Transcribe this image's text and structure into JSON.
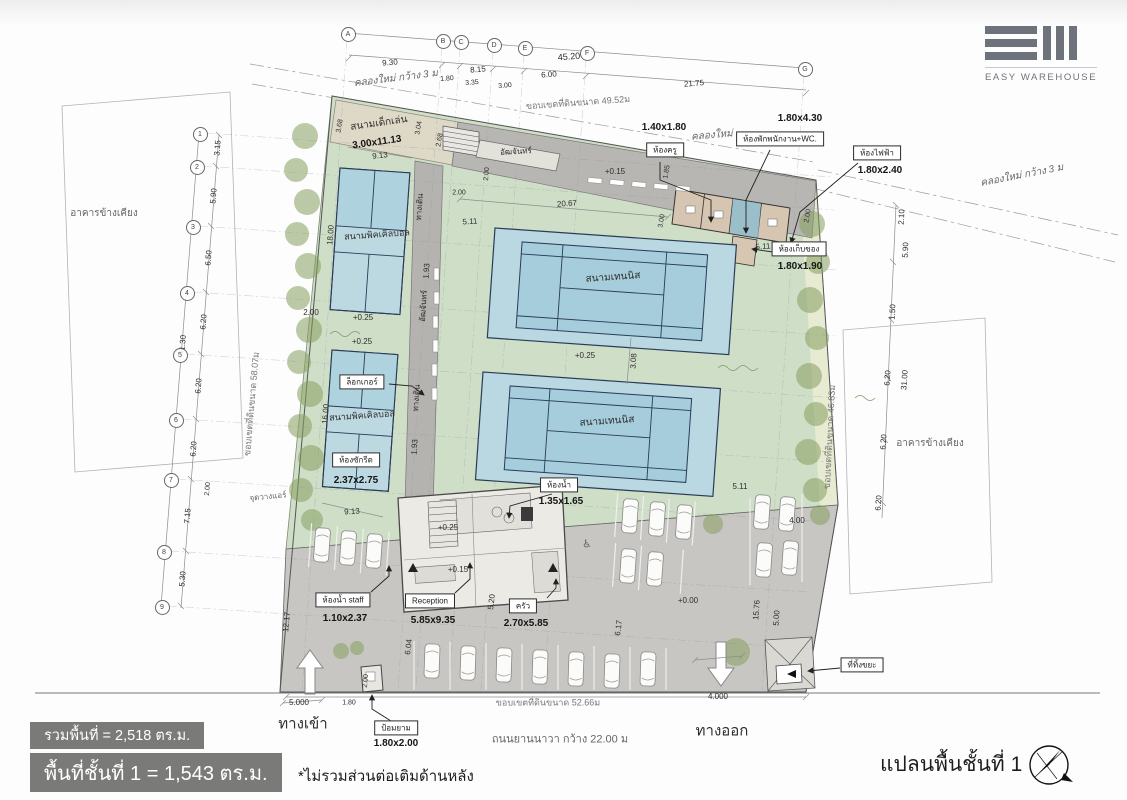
{
  "brand": {
    "name": "EASY WAREHOUSE"
  },
  "plan": {
    "title": "แปลนพื้นชั้นที่ 1",
    "summary": {
      "total_area": "รวมพื้นที่ = 2,518 ตร.ม.",
      "floor1_area": "พื้นที่ชั้นที่ 1 = 1,543 ตร.ม.",
      "note": "*ไม่รวมส่วนต่อเติมด้านหลัง"
    }
  },
  "site": {
    "boundary_top": "ขอบเขตที่ดินขนาด 49.52ม",
    "boundary_left": "ขอบเขตที่ดินขนาด 58.07ม",
    "boundary_right": "ขอบเขตที่ดินขนาด 46.83ม",
    "boundary_bottom": "ขอบเขตที่ดินขนาด 52.66ม",
    "road": "ถนนยานนาวา กว้าง 22.00 ม",
    "canal_left": "คลองใหม่ กว้าง 3 ม",
    "canal_right": "คลองใหม่ กว้าง 3 ม",
    "canal_top": "คลองใหม่",
    "neighbor_left": "อาคารข้างเคียง",
    "neighbor_right": "อาคารข้างเคียง",
    "entrance": "ทางเข้า",
    "exit": "ทางออก",
    "walkway": "ทางเดิน",
    "grandstand": "อัฒจันทร์"
  },
  "areas": {
    "playground": {
      "label": "สนามเด็กเล่น",
      "size": "3.00x11.13"
    },
    "pickleball_1": {
      "label": "สนามพิคเคิลบอล"
    },
    "pickleball_2": {
      "label": "สนามพิคเคิลบอล"
    },
    "tennis_1": {
      "label": "สนามเทนนิส"
    },
    "tennis_2": {
      "label": "สนามเทนนิส"
    }
  },
  "callouts": {
    "teacher_room": {
      "label": "ห้องครู",
      "size": "1.40x1.80"
    },
    "staff_room_wc": {
      "label": "ห้องพักพนักงาน+WC.",
      "size": "1.80x4.30"
    },
    "electrical_room": {
      "label": "ห้องไฟฟ้า",
      "size": "1.80x2.40"
    },
    "storage_room": {
      "label": "ห้องเก็บของ",
      "size": "1.80x1.90"
    },
    "locker": {
      "label": "ล็อกเกอร์"
    },
    "laundry_room": {
      "label": "ห้องซักรีด",
      "size": "2.37x2.75"
    },
    "toilet": {
      "label": "ห้องน้ำ",
      "size": "1.35x1.65"
    },
    "staff_toilet": {
      "label": "ห้องน้ำ staff",
      "size": "1.10x2.37"
    },
    "reception": {
      "label": "Reception",
      "size": "5.85x9.35"
    },
    "kitchen": {
      "label": "ครัว",
      "size": "2.70x5.85"
    },
    "guard_post": {
      "label": "ป้อมยาม",
      "size": "1.80x2.00"
    },
    "trash_area": {
      "label": "ที่ทิ้งขยะ"
    }
  },
  "misc": {
    "ac_point": "จุดวางแอร์",
    "wheelchair": "♿"
  },
  "levels": {
    "p25": "+0.25",
    "p15": "+0.15",
    "p00": "+0.00"
  },
  "grid": {
    "columns": [
      "A",
      "B",
      "C",
      "D",
      "E",
      "F",
      "G"
    ],
    "rows": [
      "1",
      "2",
      "3",
      "4",
      "5",
      "6",
      "7",
      "8",
      "9"
    ]
  },
  "dimensions": {
    "top_overall": "45.20",
    "top": [
      "9.30",
      "8.15",
      "6.00",
      "21.75"
    ],
    "top_sub": [
      "1.80",
      "3.35",
      "3.00"
    ],
    "left": [
      "3.15",
      "5.90",
      "6.50",
      "6.20",
      "6.20",
      "6.20",
      "7.15",
      "5.30"
    ],
    "left_overall": "41.30",
    "right": [
      "2.10",
      "5.90",
      "1.50",
      "6.20",
      "6.20",
      "6.20",
      "4.00"
    ],
    "right_overall": "31.00",
    "court": [
      "20.67",
      "5.11",
      "3.08",
      "1.93",
      "9.13",
      "18.00",
      "16.00",
      "2.00",
      "2.68",
      "3.04",
      "3.68",
      "1.85",
      "3.00"
    ],
    "parking": [
      "12.17",
      "6.04",
      "5.20",
      "6.17",
      "15.76",
      "5.00",
      "5.000",
      "4.000",
      "1.80",
      "2.00"
    ]
  },
  "colors": {
    "green_zone": "#cfdec7",
    "court_blue": "#b9d8e2",
    "court_line": "#2a3b58",
    "walkway_gray": "#b6b5b1",
    "parking_gray": "#c7c6c2",
    "room_tan": "#d7c6b1",
    "infobox_gray": "#7a7a78",
    "logo_gray": "#6e727a"
  }
}
